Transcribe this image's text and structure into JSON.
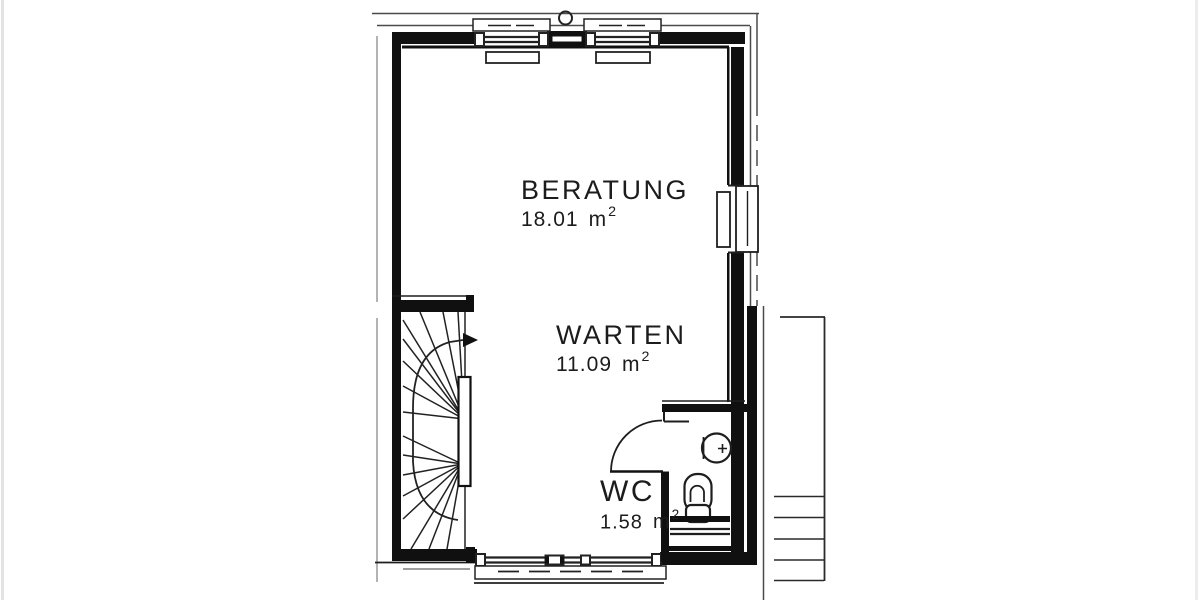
{
  "plan": {
    "colors": {
      "ink": "#141414",
      "paper": "#ffffff"
    },
    "rooms": [
      {
        "name": "BERATUNG",
        "area_value": "18.01",
        "area_unit": "m",
        "area_exp": "2"
      },
      {
        "name": "WARTEN",
        "area_value": "11.09",
        "area_unit": "m",
        "area_exp": "2"
      },
      {
        "name": "WC",
        "area_value": "1.58",
        "area_unit": "m",
        "area_exp": "2"
      }
    ],
    "symbols": [
      "winder-staircase-icon",
      "stair-run-arrow-icon",
      "door-swing-icon",
      "entrance-door-icon",
      "window-icon",
      "radiator-icon",
      "washbasin-icon",
      "toilet-icon",
      "vent-pipe-icon",
      "exterior-stairs-icon"
    ]
  }
}
